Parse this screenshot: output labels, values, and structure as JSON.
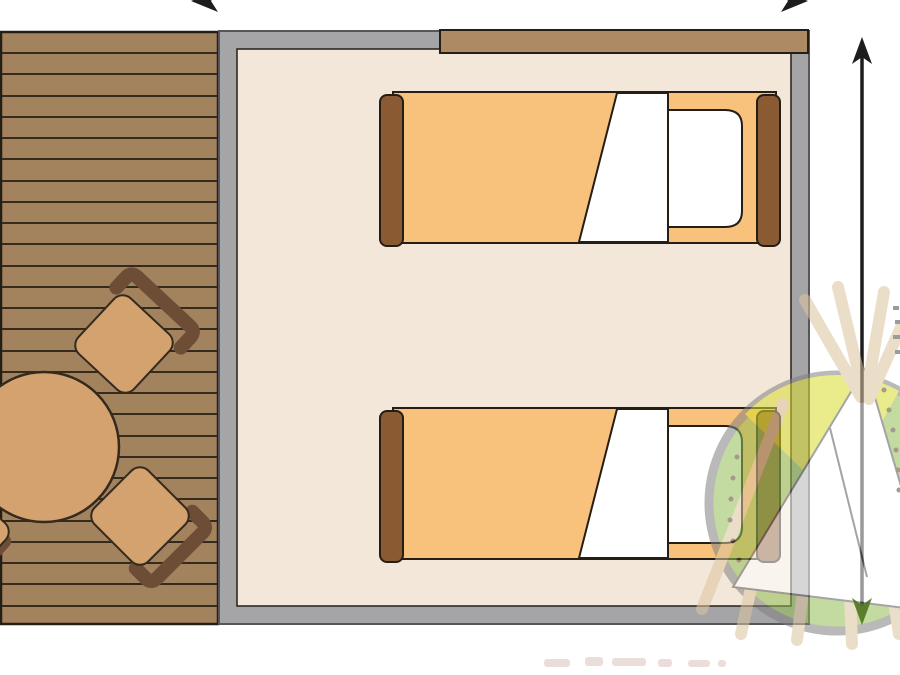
{
  "meta": {
    "title": "Glamping safari-tent floor plan",
    "type": "floor-plan illustration, top view",
    "visible_text": "none (no legible text in image)"
  },
  "palette": {
    "bg": "#ffffff",
    "deckWood": "#a3825e",
    "deckLine": "#352a1e",
    "outline": "#241e16",
    "wallGray": "#a5a5a7",
    "wallEdge": "#56565a",
    "floorBeige": "#f3e7da",
    "stripBrown": "#ad8a63",
    "bedOrange": "#f8c17c",
    "bedWhite": "#ffffff",
    "barBrown": "#8a5a33",
    "furnTan": "#d3a26e",
    "backrestBrown": "#6d4d36",
    "arrowBlack": "#1d1d1d",
    "arrowGreen": "#50731f",
    "logoGreen": "#93bf55",
    "logoYellow": "#d9dc2e",
    "logoTan": "#dcc49e",
    "logoGray": "#808080",
    "logoWhite": "#ffffff",
    "logoLine": "#5a5a5a",
    "dotBrown": "#5c462f",
    "remnant": "#c7a193"
  },
  "scene": {
    "deck": {
      "name": "wooden deck terrace",
      "plank_count": 28
    },
    "room": {
      "name": "tent bedroom",
      "wall_color_key": "wallGray",
      "floor_color_key": "floorBeige",
      "entrance_beam": "brown strip along top wall"
    },
    "beds": [
      {
        "name": "single bed top",
        "parts": [
          "footboard",
          "orange blanket",
          "folded white sheet",
          "white pillow",
          "headboard"
        ]
      },
      {
        "name": "single bed bottom",
        "parts": [
          "footboard",
          "orange blanket",
          "folded white sheet",
          "white pillow",
          "headboard"
        ]
      }
    ],
    "table": {
      "name": "round dining table",
      "shape": "circle, clipped at left edge"
    },
    "chairs": [
      {
        "name": "chair upper",
        "orientation": "backrest to upper-right"
      },
      {
        "name": "chair lower",
        "orientation": "backrest to lower-right"
      },
      {
        "name": "chair partial",
        "orientation": "clipped at left edge"
      }
    ],
    "dimensions": {
      "vertical_arrow": {
        "name": "height dimension arrow",
        "style": "double-headed, black, lower head tinted green by watermark"
      },
      "horizontal_arrow": {
        "name": "width dimension arrow",
        "style": "only arrowhead fragments visible at top edge (clipped)"
      }
    },
    "watermark": {
      "name": "teepee tent logo",
      "style": "semi-transparent circle, green/yellow, white teepee with poles and dots"
    },
    "footer_remnant": {
      "name": "faint cropped watermark text marks near bottom edge"
    }
  }
}
